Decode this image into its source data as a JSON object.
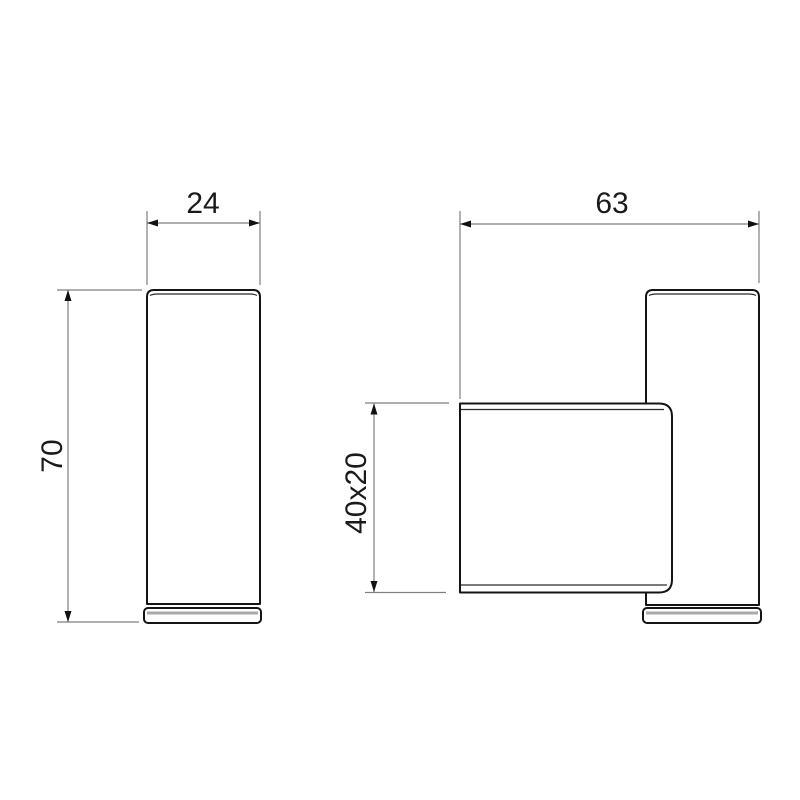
{
  "colors": {
    "background": "#ffffff",
    "outline": "#141414",
    "inner-line": "#2a2a2a",
    "cap-shade": "#a8a8a8",
    "dim-line": "#7f7f7f",
    "arrow": "#111111",
    "text": "#1a1a1a"
  },
  "views": {
    "side": {
      "dims": {
        "width": {
          "label": "24"
        },
        "height": {
          "label": "70"
        }
      }
    },
    "front": {
      "dims": {
        "width": {
          "label": "63"
        },
        "profile": {
          "label": "40x20"
        }
      }
    }
  }
}
